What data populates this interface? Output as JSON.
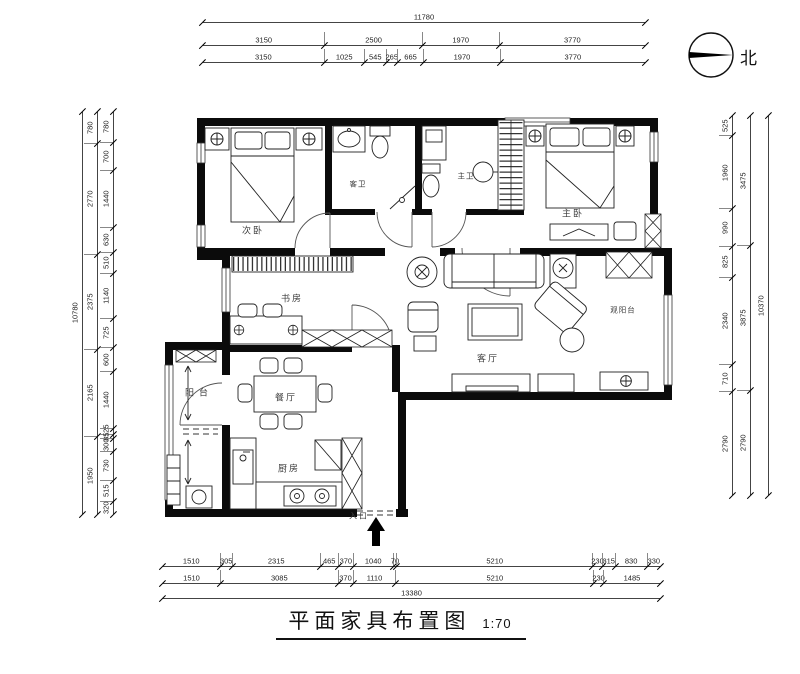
{
  "colors": {
    "ink": "#111111",
    "background": "#ffffff"
  },
  "compass": {
    "label": "北"
  },
  "title": {
    "text": "平面家具布置图",
    "scale": "1:70"
  },
  "rooms": {
    "secondary_bedroom": "次卧",
    "guest_bath": "客卫",
    "master_bath": "主卫",
    "master_bedroom": "主卧",
    "study": "书房",
    "living_room": "客厅",
    "view_balcony": "观阳台",
    "dining_room": "餐厅",
    "balcony": "阳台",
    "kitchen": "厨房",
    "entrance": "入口"
  },
  "dimensions": {
    "top": {
      "total": [
        "11780"
      ],
      "row2": [
        "3150",
        "2500",
        "1970",
        "3770"
      ],
      "row3": [
        "3150",
        "1025",
        "545",
        "265",
        "665",
        "1970",
        "3770"
      ]
    },
    "bottom": {
      "row1": [
        "1510",
        "305",
        "2315",
        "465",
        "370",
        "1040",
        "70",
        "5210",
        "230",
        "315",
        "830",
        "330"
      ],
      "row2": [
        "1510",
        "3085",
        "370",
        "1110",
        "5210",
        "230",
        "1485"
      ],
      "total": [
        "13380"
      ]
    },
    "left": {
      "outer_total": [
        "10780"
      ],
      "middle": [
        "780",
        "2770",
        "2375",
        "2165",
        "1950"
      ],
      "inner": [
        "780",
        "700",
        "1440",
        "630",
        "510",
        "1140",
        "725",
        "600",
        "1440",
        "125",
        "85",
        "300",
        "730",
        "515",
        "320"
      ]
    },
    "right": {
      "inner": [
        "525",
        "1960",
        "990",
        "825",
        "2340",
        "710",
        "2790"
      ],
      "middle": [
        "3475",
        "3875",
        "2790"
      ],
      "outer_total": [
        "10370"
      ]
    }
  }
}
